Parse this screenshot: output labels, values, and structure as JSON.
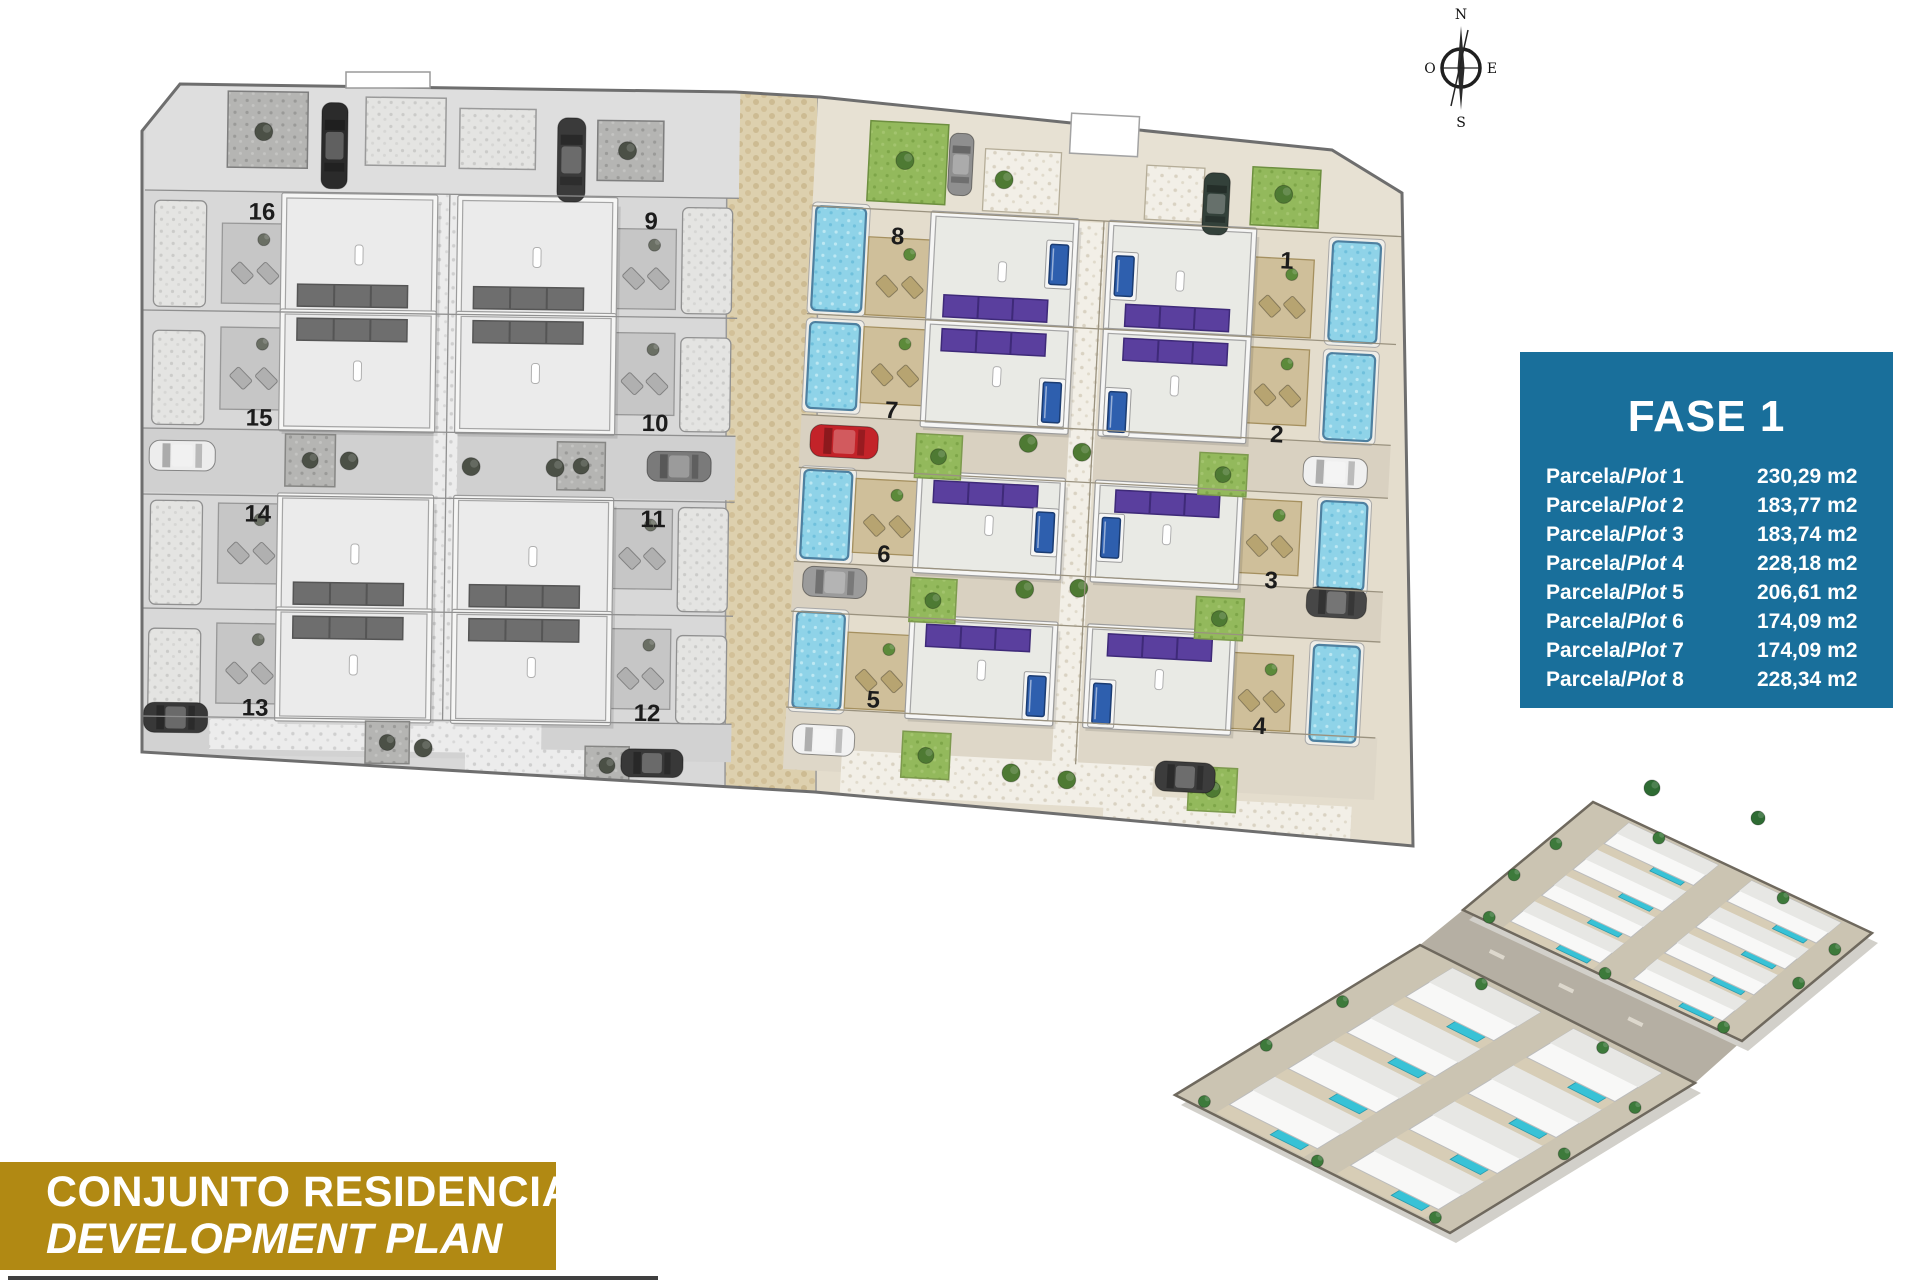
{
  "compass": {
    "north": "N",
    "south": "S",
    "east": "E",
    "west": "O"
  },
  "site_plan": {
    "plot_numbers": [
      "16",
      "15",
      "14",
      "13",
      "9",
      "10",
      "11",
      "12",
      "8",
      "7",
      "6",
      "5",
      "1",
      "2",
      "3",
      "4"
    ]
  },
  "fase_box": {
    "title": "FASE 1",
    "rows": [
      {
        "prefix": "Parcela/",
        "plot_word": "Plot",
        "number": "1",
        "area": "230,29 m2"
      },
      {
        "prefix": "Parcela/",
        "plot_word": "Plot",
        "number": "2",
        "area": "183,77 m2"
      },
      {
        "prefix": "Parcela/",
        "plot_word": "Plot",
        "number": "3",
        "area": "183,74 m2"
      },
      {
        "prefix": "Parcela/",
        "plot_word": "Plot",
        "number": "4",
        "area": "228,18 m2"
      },
      {
        "prefix": "Parcela/",
        "plot_word": "Plot",
        "number": "5",
        "area": "206,61 m2"
      },
      {
        "prefix": "Parcela/",
        "plot_word": "Plot",
        "number": "6",
        "area": "174,09 m2"
      },
      {
        "prefix": "Parcela/",
        "plot_word": "Plot",
        "number": "7",
        "area": "174,09 m2"
      },
      {
        "prefix": "Parcela/",
        "plot_word": "Plot",
        "number": "8",
        "area": "228,34 m2"
      }
    ]
  },
  "banner": {
    "line1": "CONJUNTO RESIDENCIAL",
    "line2": "DEVELOPMENT PLAN"
  },
  "colors": {
    "fase_bg": "#196F9B",
    "banner_bg": "#B18913",
    "solar_panel_purple": "#5A3F9E",
    "pool_light_blue": "#8FD3E8",
    "pool_dark_blue": "#2E5FAE",
    "lawn_green": "#93B95C",
    "cobble_beige": "#DDD0AE"
  }
}
